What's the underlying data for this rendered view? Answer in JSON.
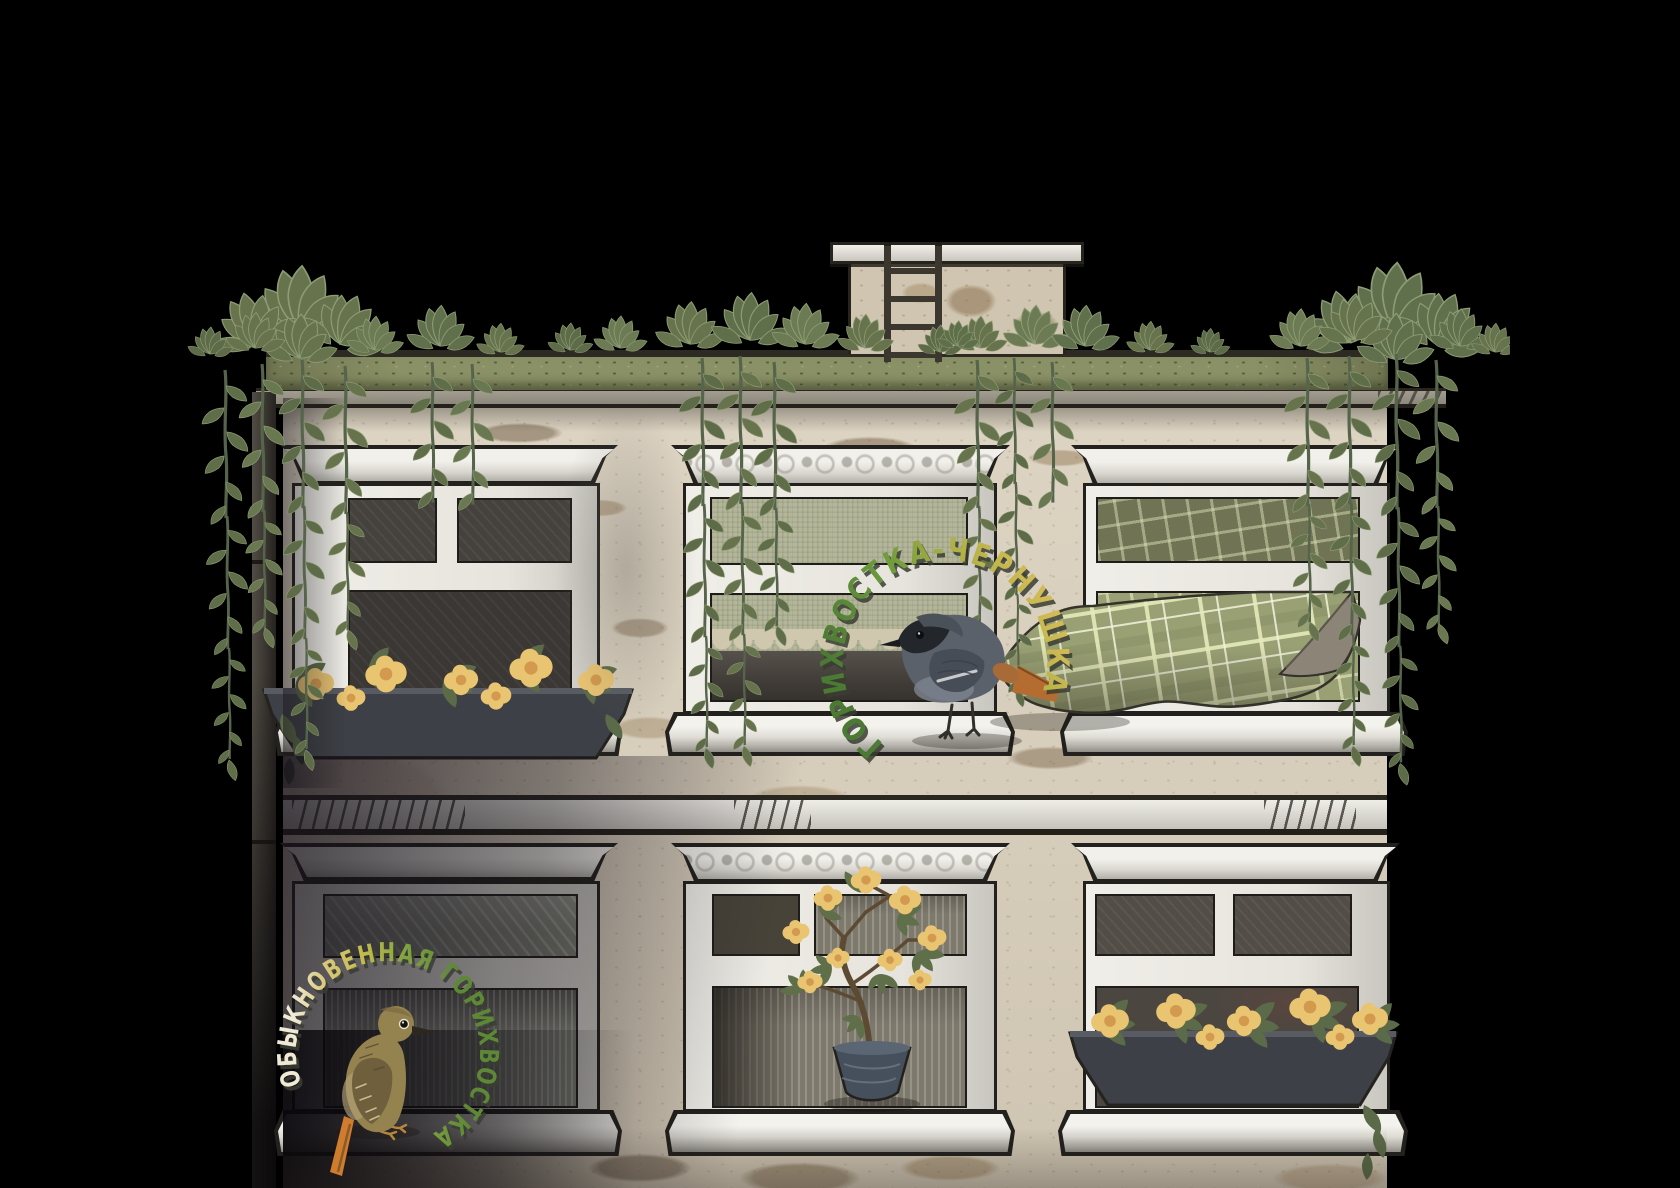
{
  "labels": {
    "upper_bird": "ГОРИХВОСТКА-ЧЕРНУШКА",
    "lower_bird": "ОБЫКНОВЕННАЯ ГОРИХВОСТКА"
  },
  "palette": {
    "background": "#000000",
    "wall": "#d8cebc",
    "wall_patch": "#9a8265",
    "roof_ledge_green": "#8b9166",
    "ivy_green": "#66734d",
    "window_frame": "#e8e6de",
    "window_pane": "#46423d",
    "plaid_blanket": "#99a074",
    "marigold": "#e9c471",
    "redstart_tail_orange": "#c1702f",
    "label_green": "#6f9c3e",
    "label_yellow": "#d2bb55",
    "label_cream": "#efe9d6"
  }
}
